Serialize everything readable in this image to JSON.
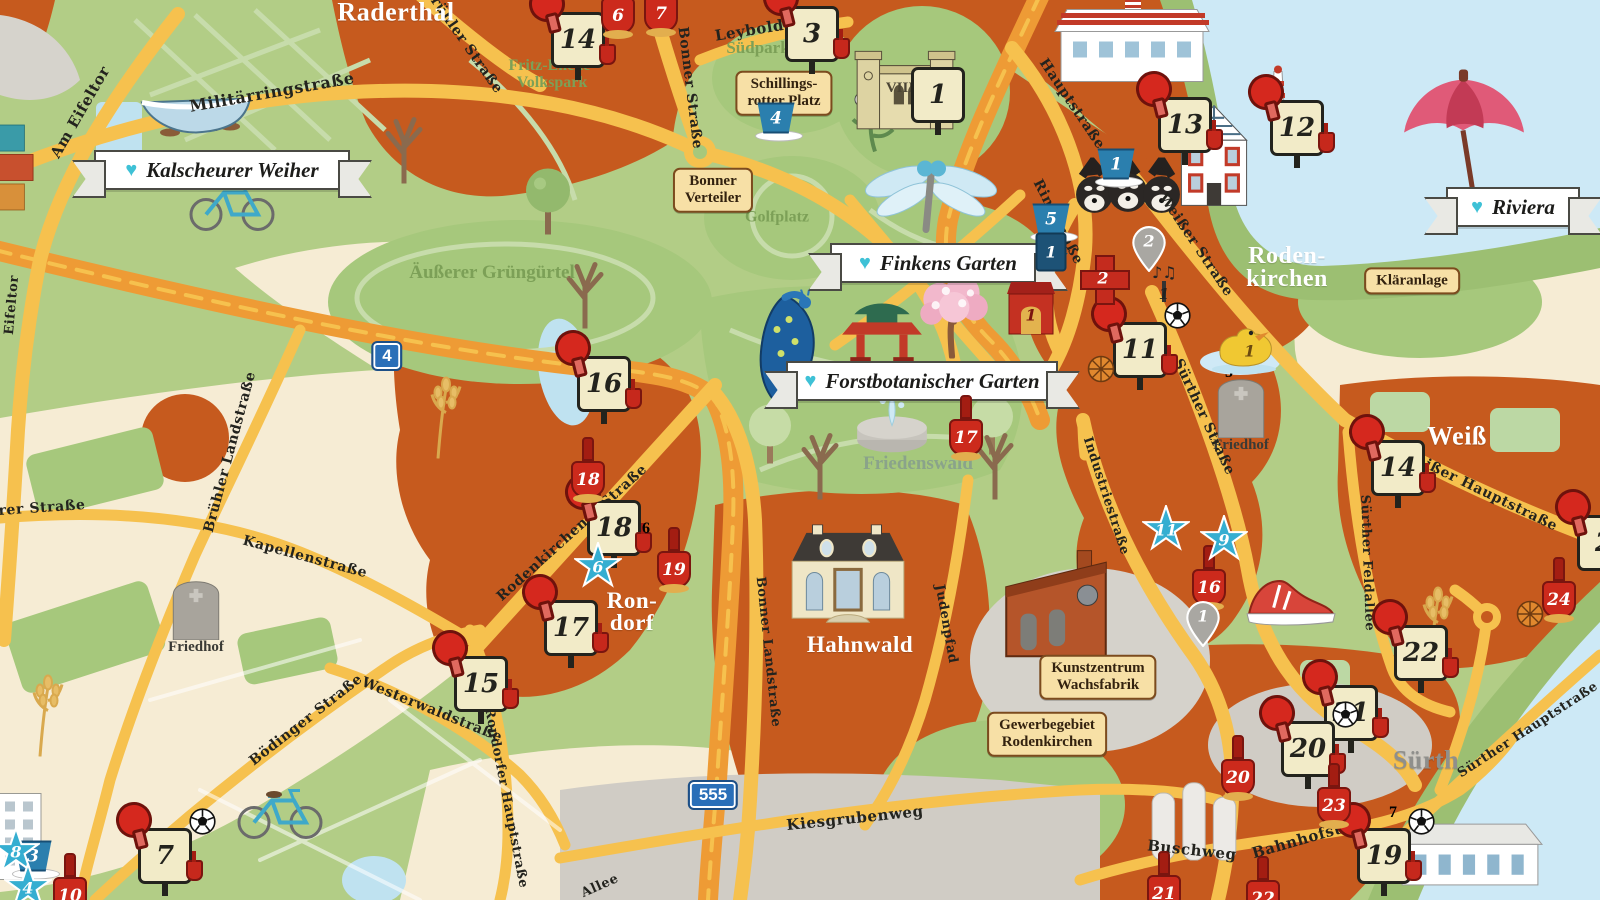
{
  "map_type": "illustrated-district-map",
  "colors": {
    "urban_orange": "#c65a1e",
    "park_green": "#a6c87c",
    "base_green": "#b2cd86",
    "field_cream": "#f6ecd4",
    "water_blue": "#cde9f6",
    "road_yellow": "#f6c14e",
    "motorway_orange": "#ee9b35",
    "industry_gray": "#d0ccc5",
    "banner_heart": "#3ec1d6",
    "plaque_tan": "#f7e0a6",
    "marker_red": "#d5281e",
    "marker_blue": "#2b7fae",
    "star_blue": "#35aed1",
    "square_green": "#5d7f45"
  },
  "regions": [
    {
      "text": "Raderthal",
      "x": 396,
      "y": 13,
      "size": 26
    },
    {
      "text": "Roden-\nkirchen",
      "x": 1287,
      "y": 268,
      "size": 24
    },
    {
      "text": "Ron-\ndorf",
      "x": 632,
      "y": 612,
      "size": 23
    },
    {
      "text": "Hahnwald",
      "x": 860,
      "y": 645,
      "size": 23
    },
    {
      "text": "Weiß",
      "x": 1457,
      "y": 437,
      "size": 26
    },
    {
      "text": "Sürth",
      "x": 1426,
      "y": 761,
      "size": 26,
      "color": "#8f8f8c"
    }
  ],
  "banners": [
    {
      "text": "Kalscheurer Weiher",
      "x": 222,
      "y": 170,
      "w": 252
    },
    {
      "text": "Finkens Garten",
      "x": 938,
      "y": 263,
      "w": 212
    },
    {
      "text": "Forstbotanischer Garten",
      "x": 922,
      "y": 381,
      "w": 268
    },
    {
      "text": "Riviera",
      "x": 1513,
      "y": 207,
      "w": 130
    }
  ],
  "plaques": [
    {
      "text": "Schillings-\nrotter Platz",
      "x": 784,
      "y": 93
    },
    {
      "text": "Bonner\nVerteiler",
      "x": 713,
      "y": 190
    },
    {
      "text": "Kläranlage",
      "x": 1412,
      "y": 281
    },
    {
      "text": "Kunstzentrum\nWachsfabrik",
      "x": 1098,
      "y": 677
    },
    {
      "text": "Gewerbegebiet\nRodenkirchen",
      "x": 1047,
      "y": 734
    }
  ],
  "park_labels": [
    {
      "text": "Fritz-Encke-\nVolkspark",
      "x": 552,
      "y": 75,
      "size": 16
    },
    {
      "text": "Südpark",
      "x": 758,
      "y": 48,
      "size": 17
    },
    {
      "text": "Golfplatz",
      "x": 777,
      "y": 218,
      "size": 16
    },
    {
      "text": "Äußerer Grüngürtel",
      "x": 492,
      "y": 273,
      "size": 19
    },
    {
      "text": "Friedenswald",
      "x": 918,
      "y": 464,
      "size": 19,
      "color": "#8aa38a"
    }
  ],
  "street_labels": [
    {
      "text": "Militärringstraße",
      "x": 272,
      "y": 92,
      "rot": -10,
      "size": 16
    },
    {
      "text": "Am Eifeltor",
      "x": 80,
      "y": 112,
      "rot": -60,
      "size": 15
    },
    {
      "text": "Eifeltor",
      "x": 12,
      "y": 305,
      "rot": -85,
      "size": 13
    },
    {
      "text": "Brühler Straße",
      "x": 463,
      "y": 40,
      "rot": 55
    },
    {
      "text": "Bonner Straße",
      "x": 690,
      "y": 88,
      "rot": 83
    },
    {
      "text": "Leyboldstr.",
      "x": 764,
      "y": 28,
      "rot": -9,
      "size": 15
    },
    {
      "text": "Hauptstraße",
      "x": 1072,
      "y": 104,
      "rot": 56
    },
    {
      "text": "Ringstraße",
      "x": 1058,
      "y": 222,
      "rot": 63
    },
    {
      "text": "Weißer Straße",
      "x": 1196,
      "y": 245,
      "rot": 56
    },
    {
      "text": "Rodenkirchener Straße",
      "x": 572,
      "y": 533,
      "rot": -42
    },
    {
      "text": "Brühler Landstraße",
      "x": 230,
      "y": 452,
      "rot": -75
    },
    {
      "text": "rer Straße",
      "x": 42,
      "y": 508,
      "rot": -4
    },
    {
      "text": "Kapellenstraße",
      "x": 305,
      "y": 557,
      "rot": 15
    },
    {
      "text": "Bödinger Straße",
      "x": 306,
      "y": 720,
      "rot": -38
    },
    {
      "text": "Westerwaldstraße",
      "x": 432,
      "y": 710,
      "rot": 22
    },
    {
      "text": "Rondorfer Hauptstraße",
      "x": 506,
      "y": 798,
      "rot": 79,
      "size": 13
    },
    {
      "text": "Bonner Landstraße",
      "x": 768,
      "y": 652,
      "rot": 84,
      "size": 13
    },
    {
      "text": "Judenpfad",
      "x": 946,
      "y": 624,
      "rot": 80,
      "size": 13
    },
    {
      "text": "Industriestraße",
      "x": 1106,
      "y": 496,
      "rot": 72,
      "size": 13
    },
    {
      "text": "Sürther Straße",
      "x": 1204,
      "y": 417,
      "rot": 65
    },
    {
      "text": "Sürther Feldallee",
      "x": 1367,
      "y": 563,
      "rot": 88,
      "size": 13
    },
    {
      "text": "Weißer Hauptstraße",
      "x": 1480,
      "y": 490,
      "rot": 26
    },
    {
      "text": "Sürther Hauptstraße",
      "x": 1528,
      "y": 730,
      "rot": -33,
      "size": 13
    },
    {
      "text": "Kiesgrubenweg",
      "x": 855,
      "y": 818,
      "rot": -6,
      "size": 15
    },
    {
      "text": "Buschweg",
      "x": 1192,
      "y": 850,
      "rot": 6,
      "size": 15
    },
    {
      "text": "Bahnhofstr.",
      "x": 1303,
      "y": 839,
      "rot": -16,
      "size": 15
    },
    {
      "text": "Allee",
      "x": 600,
      "y": 886,
      "rot": -24,
      "size": 13
    }
  ],
  "route_shields": [
    {
      "number": "4",
      "x": 387,
      "y": 356
    },
    {
      "number": "555",
      "x": 713,
      "y": 795
    }
  ],
  "markers": [
    {
      "type": "paddle-sign",
      "number": "14",
      "x": 578,
      "y": 40
    },
    {
      "type": "paddle-sign",
      "number": "3",
      "x": 812,
      "y": 34
    },
    {
      "type": "paddle-sign",
      "number": "13",
      "x": 1185,
      "y": 125
    },
    {
      "type": "paddle-sign",
      "number": "12",
      "x": 1297,
      "y": 128
    },
    {
      "type": "paddle-sign",
      "number": "16",
      "x": 604,
      "y": 384
    },
    {
      "type": "paddle-sign",
      "number": "18",
      "x": 614,
      "y": 528
    },
    {
      "type": "paddle-sign",
      "number": "17",
      "x": 571,
      "y": 628
    },
    {
      "type": "paddle-sign",
      "number": "15",
      "x": 481,
      "y": 684
    },
    {
      "type": "paddle-sign",
      "number": "7",
      "x": 165,
      "y": 856,
      "extras": [
        "soccer"
      ]
    },
    {
      "type": "paddle-sign",
      "number": "11",
      "x": 1140,
      "y": 350,
      "extras": [
        "soccer",
        "basketball"
      ]
    },
    {
      "type": "paddle-sign",
      "number": "14",
      "x": 1398,
      "y": 468
    },
    {
      "type": "paddle-sign",
      "number": "22",
      "x": 1421,
      "y": 653
    },
    {
      "type": "paddle-sign",
      "number": "21",
      "x": 1351,
      "y": 713
    },
    {
      "type": "paddle-sign",
      "number": "20",
      "x": 1308,
      "y": 749,
      "extras": [
        "soccer"
      ]
    },
    {
      "type": "paddle-sign",
      "number": "19",
      "x": 1384,
      "y": 856,
      "extras": [
        "soccer"
      ]
    },
    {
      "type": "paddle-sign",
      "number": "2",
      "x": 1604,
      "y": 543
    },
    {
      "type": "shovel",
      "number": "6",
      "x": 618,
      "y": 6
    },
    {
      "type": "shovel",
      "number": "7",
      "x": 661,
      "y": 4
    },
    {
      "type": "shovel",
      "number": "18",
      "x": 588,
      "y": 470
    },
    {
      "type": "shovel",
      "number": "19",
      "x": 674,
      "y": 560
    },
    {
      "type": "shovel",
      "number": "17",
      "x": 966,
      "y": 428
    },
    {
      "type": "shovel",
      "number": "16",
      "x": 1209,
      "y": 578
    },
    {
      "type": "shovel",
      "number": "24",
      "x": 1559,
      "y": 590,
      "extras": [
        "basketball"
      ]
    },
    {
      "type": "shovel",
      "number": "20",
      "x": 1238,
      "y": 768
    },
    {
      "type": "shovel",
      "number": "23",
      "x": 1334,
      "y": 796
    },
    {
      "type": "shovel",
      "number": "21",
      "x": 1164,
      "y": 884
    },
    {
      "type": "shovel",
      "number": "22",
      "x": 1263,
      "y": 889
    },
    {
      "type": "shovel",
      "number": "10",
      "x": 70,
      "y": 886
    },
    {
      "type": "bucket",
      "number": "4",
      "x": 779,
      "y": 122
    },
    {
      "type": "bucket",
      "number": "5",
      "x": 1054,
      "y": 223
    },
    {
      "type": "bucket",
      "number": "1",
      "x": 1119,
      "y": 168
    },
    {
      "type": "bucket",
      "number": "3",
      "x": 36,
      "y": 860
    },
    {
      "type": "pillar",
      "number": "1",
      "x": 1051,
      "y": 252
    },
    {
      "type": "star",
      "number": "6",
      "x": 598,
      "y": 566
    },
    {
      "type": "star",
      "number": "11",
      "x": 1166,
      "y": 529
    },
    {
      "type": "star",
      "number": "9",
      "x": 1224,
      "y": 539
    },
    {
      "type": "star",
      "number": "8",
      "x": 16,
      "y": 851
    },
    {
      "type": "star",
      "number": "4",
      "x": 28,
      "y": 887
    },
    {
      "type": "green-square",
      "number": "6",
      "x": 646,
      "y": 529
    },
    {
      "type": "green-square",
      "number": "5",
      "x": 1229,
      "y": 373
    },
    {
      "type": "green-square",
      "number": "7",
      "x": 1393,
      "y": 813
    },
    {
      "type": "pin",
      "number": "2",
      "x": 1149,
      "y": 249
    },
    {
      "type": "pin",
      "number": "1",
      "x": 1203,
      "y": 624
    },
    {
      "type": "cross",
      "number": "2",
      "x": 1103,
      "y": 278
    },
    {
      "type": "theater",
      "number": "1",
      "x": 1031,
      "y": 308
    },
    {
      "type": "piano",
      "number": "1",
      "x": 1164,
      "y": 292
    },
    {
      "type": "duck",
      "number": "1",
      "x": 1244,
      "y": 348
    },
    {
      "type": "sign",
      "number": "1",
      "x": 938,
      "y": 95
    }
  ],
  "illustrations": [
    {
      "type": "containers",
      "x": 14,
      "y": 170
    },
    {
      "type": "rowboat",
      "x": 196,
      "y": 116
    },
    {
      "type": "bicycle",
      "x": 232,
      "y": 206
    },
    {
      "type": "bicycle",
      "x": 280,
      "y": 814
    },
    {
      "type": "tree-bare",
      "x": 404,
      "y": 150
    },
    {
      "type": "tree-green",
      "x": 548,
      "y": 205
    },
    {
      "type": "tree-bare",
      "x": 585,
      "y": 295
    },
    {
      "type": "tree-light",
      "x": 770,
      "y": 437
    },
    {
      "type": "tree-bare",
      "x": 820,
      "y": 466
    },
    {
      "type": "tree-light",
      "x": 992,
      "y": 428
    },
    {
      "type": "tree-bare",
      "x": 995,
      "y": 466
    },
    {
      "type": "flower",
      "x": 872,
      "y": 120
    },
    {
      "type": "dragonfly",
      "x": 930,
      "y": 196
    },
    {
      "type": "peacock",
      "x": 790,
      "y": 352
    },
    {
      "type": "pagoda",
      "x": 882,
      "y": 330
    },
    {
      "type": "cherry",
      "x": 952,
      "y": 318
    },
    {
      "type": "fountain",
      "x": 892,
      "y": 424
    },
    {
      "type": "fort",
      "x": 905,
      "y": 66,
      "label": "VIIIB"
    },
    {
      "type": "waterworks",
      "x": 1132,
      "y": 42
    },
    {
      "type": "beacon",
      "x": 1278,
      "y": 98
    },
    {
      "type": "halftimber",
      "x": 1214,
      "y": 158
    },
    {
      "type": "raccoons",
      "x": 1128,
      "y": 196
    },
    {
      "type": "umbrella",
      "x": 1464,
      "y": 138
    },
    {
      "type": "villa",
      "x": 848,
      "y": 578
    },
    {
      "type": "factory",
      "x": 1056,
      "y": 610
    },
    {
      "type": "sneaker",
      "x": 1290,
      "y": 604
    },
    {
      "type": "gravestone",
      "x": 196,
      "y": 612,
      "label": "Friedhof"
    },
    {
      "type": "gravestone",
      "x": 1241,
      "y": 410,
      "label": "Friedhof"
    },
    {
      "type": "wheat",
      "x": 446,
      "y": 418
    },
    {
      "type": "wheat",
      "x": 48,
      "y": 716
    },
    {
      "type": "wheat",
      "x": 1438,
      "y": 628
    },
    {
      "type": "apartment",
      "x": 20,
      "y": 838
    },
    {
      "type": "silos",
      "x": 1195,
      "y": 822
    },
    {
      "type": "station",
      "x": 1470,
      "y": 856
    }
  ]
}
